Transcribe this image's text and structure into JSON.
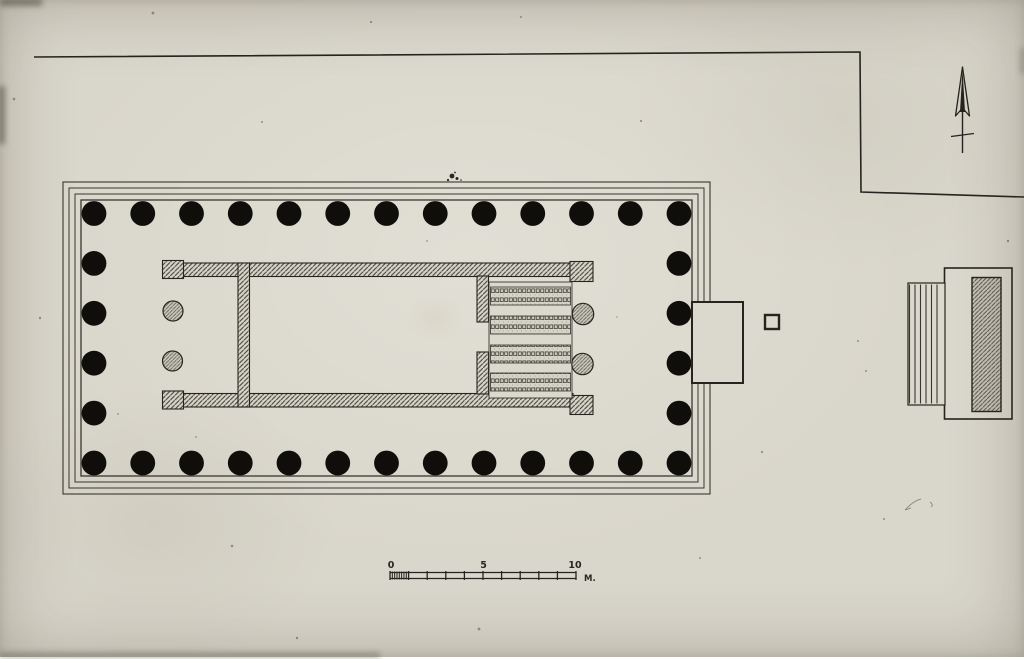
{
  "drawing": {
    "kind": "measured ground plan, ink on aged paper",
    "subject": "peripteral temple with altar to the east"
  },
  "scale_bar": {
    "tick_labels": [
      "0",
      "5",
      "10"
    ],
    "unit_label": "M.",
    "major_divisions": 10,
    "fine_divisions": 8
  },
  "diagram_data": {
    "type": "architectural-plan",
    "peristyle": {
      "long_side_columns": 13,
      "short_side_columns": 6,
      "total_columns": 34
    },
    "stylobate_steps": 4,
    "west_porch_columns_in_antis": 2,
    "east_porch_columns_in_antis": 2,
    "pronaos_floor_bands": 4,
    "altar": {
      "steps_side": "west",
      "step_lines": 6
    },
    "north_arrow": "points up",
    "ramp": "east side of temple",
    "detached_square_base": 1
  },
  "colors": {
    "paper": "#d9d6cb",
    "ink": "#26241f",
    "thin_line": "#3a372f",
    "hatch": "#4a473e",
    "column_fill": "#0f0e0b"
  }
}
